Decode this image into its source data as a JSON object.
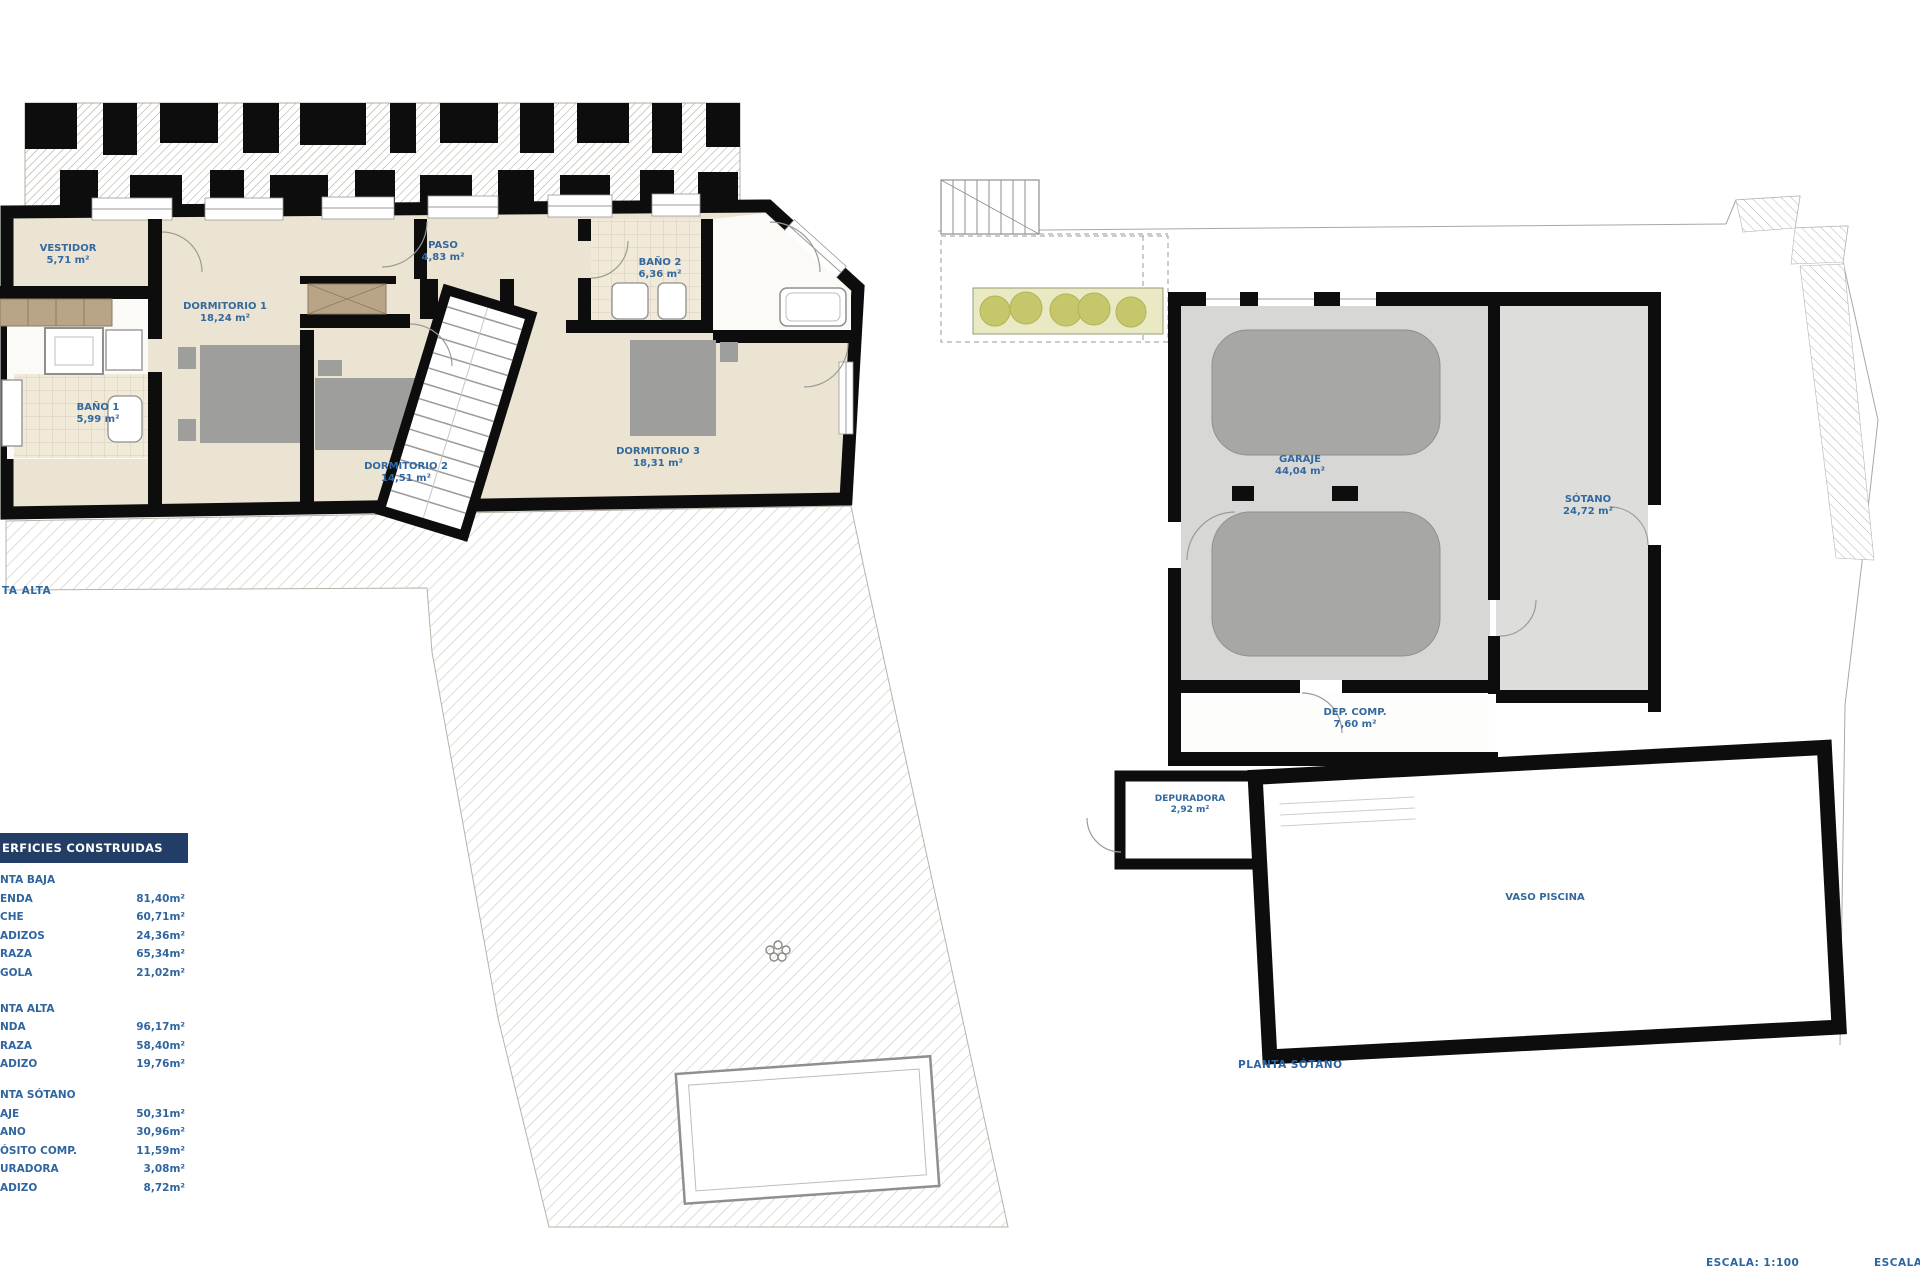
{
  "sheet": {
    "plan_upper_caption": "TA ALTA",
    "plan_basement_caption": "PLANTA SÓTANO",
    "scale_label": "ESCALA:  1:100",
    "scale_label_right": "ESCALA",
    "rooms_upper": {
      "vestidor": {
        "name": "VESTIDOR",
        "area": "5,71 m²"
      },
      "dormitorio1": {
        "name": "DORMITORIO 1",
        "area": "18,24 m²"
      },
      "bano1": {
        "name": "BAÑO 1",
        "area": "5,99 m²"
      },
      "paso": {
        "name": "PASO",
        "area": "4,83 m²"
      },
      "bano2": {
        "name": "BAÑO 2",
        "area": "6,36 m²"
      },
      "dormitorio2": {
        "name": "DORMITORIO 2",
        "area": "14,51 m²"
      },
      "dormitorio3": {
        "name": "DORMITORIO 3",
        "area": "18,31 m²"
      }
    },
    "rooms_basement": {
      "garaje": {
        "name": "GARAJE",
        "area": "44,04 m²"
      },
      "sotano": {
        "name": "SÓTANO",
        "area": "24,72 m²"
      },
      "dep_comp": {
        "name": "DEP. COMP.",
        "area": "7,60 m²"
      },
      "depuradora": {
        "name": "DEPURADORA",
        "area": "2,92 m²"
      },
      "vaso_piscina": {
        "name": "VASO PISCINA"
      }
    }
  },
  "areas_table": {
    "header": "ERFICIES CONSTRUIDAS",
    "sections": [
      {
        "title": "NTA BAJA",
        "rows": [
          [
            "ENDA",
            "81,40m²"
          ],
          [
            "CHE",
            "60,71m²"
          ],
          [
            "ADIZOS",
            "24,36m²"
          ],
          [
            "RAZA",
            "65,34m²"
          ],
          [
            "GOLA",
            "21,02m²"
          ]
        ]
      },
      {
        "title": "NTA ALTA",
        "rows": [
          [
            "NDA",
            "96,17m²"
          ],
          [
            "RAZA",
            "58,40m²"
          ],
          [
            "ADIZO",
            "19,76m²"
          ]
        ]
      },
      {
        "title": "NTA SÓTANO",
        "rows": [
          [
            "AJE",
            "50,31m²"
          ],
          [
            "ANO",
            "30,96m²"
          ],
          [
            "ÓSITO COMP.",
            "11,59m²"
          ],
          [
            "URADORA",
            "3,08m²"
          ],
          [
            "ADIZO",
            "8,72m²"
          ]
        ]
      }
    ]
  },
  "colors": {
    "label_blue": "#33699f",
    "table_blue": "#2f66a0",
    "header_navy": "#223d66",
    "floor_beige": "#ece4d2",
    "furniture_gray": "#9e9e9c",
    "garage_floor_gray": "#d7d7d5",
    "planter_olive": "#c6c66a"
  }
}
